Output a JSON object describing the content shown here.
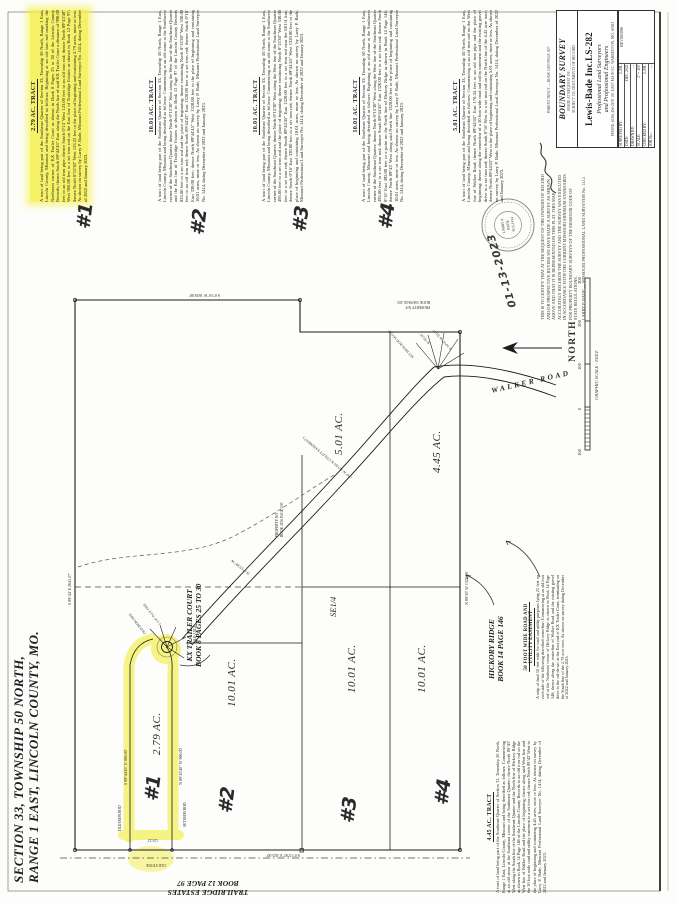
{
  "colors": {
    "highlight": "#f3ee3e",
    "ink": "#1d1d1d",
    "seal_gray": "#777777",
    "paper": "#fdfdfb"
  },
  "sheet_title": {
    "line1": "SECTION 33, TOWNSHIP 50 NORTH,",
    "line2": "RANGE 1 EAST, LINCOLN COUNTY, MO."
  },
  "labels": {
    "kx1": "KX TRAILER COURT",
    "kx2": "BOOK 8 PAGES 25 TO 30",
    "trailridge1": "TRAILRIDGE ESTATES",
    "trailridge2": "BOOK 12 PAGE 97",
    "hickory1": "HICKORY RIDGE",
    "hickory2": "BOOK 14 PAGE 146",
    "quarter": "SE1/4",
    "north": "NORTH",
    "walker_road": "WALKER ROAD",
    "scale_caption": "GRAPHIC SCALE - FEET",
    "road_easement": "( 50' W. ROAD & UTILITY EASEMENT )"
  },
  "scale_ticks": [
    "100",
    "0",
    "100",
    "200",
    "300"
  ],
  "acreage": {
    "t1": "2.79 AC.",
    "t2": "10.01 AC.",
    "t3": "10.01 AC.",
    "t4": "10.01 AC.",
    "t5": "5.01 AC.",
    "t6": "4.45 AC."
  },
  "handwritten": {
    "n1": "#1",
    "n2": "#2",
    "n3": "#3",
    "n4": "#4",
    "date": "01-13-2023"
  },
  "micro": {
    "m1": "S 89°44'45\" E  990.00'",
    "m2": "N 89°43'40\" W  966.00'",
    "m3": "S 89°44' E  2641.27'",
    "m4": "N 89°43' W  1320.00'",
    "m5": "S 0°15'30\" E  825.00'",
    "m6": "S 0°16' W  1650.00'",
    "m7": "OLD IRON ROD",
    "m8": "SET IRON ROD",
    "m9": "OLD STONE",
    "m10": "OLD IRON PIPE",
    "m11": "1-1/4\" O.I.P. FND.",
    "m12": "PROPERTY N/F",
    "m13": "BOOK 1156 PAGE 100",
    "m14": "PROPERTY N/F",
    "m15": "BOOK 558 PAGE 203",
    "m16": "SET IRON ROD W/CAP",
    "m17": "R=50.00'",
    "m18": "N 14°07' W  50.00'",
    "m19": "OLD AXLE",
    "m20": "123.22'",
    "m21": "N 0°15'30\" W"
  },
  "tracts": [
    {
      "heading": "2.79 AC. TRACT",
      "number": "#1",
      "highlighted": true,
      "body": "A tract of land being part of the Southeast Quarter of Section 33, Township 50 North, Range 1 East, Lincoln County, Missouri and being described as follows: Beginning at an old iron rod marking the Northwest corner of KX Trailer Court as shown in Book 8 Pages 25 to 30 of the Lincoln County Records; thence South 89°44'45\" East along the North line of said KX Trailer Court a distance of 990.00 feet to an old iron pipe; thence South 0°15' West 123.00 feet to an old iron rod; thence North 89°43'40\" West 966.00 feet to a set iron rod on the East line of Trailridge Estates as shown in Book 12 Page 97; thence North 0°15'30\" West 123.22 feet to the place of beginning and containing 2.79 acres, more or less. As shown on survey by Larry P. Bade, Missouri Professional Land Surveyor No. 1414, dating December of 2022 and January 2023."
    },
    {
      "heading": "10.01 AC. TRACT",
      "number": "#2",
      "highlighted": false,
      "body": "A tract of land being part of the Southeast Quarter of Section 33, Township 50 North, Range 1 East, Lincoln County, Missouri and being described as follows: Commencing at an old stone at the Southwest corner of the Southeast Quarter; thence North 0°15'30\" West along the West line of the Southeast Quarter and the East line of Trailridge Estates as shown in Book 12 Page 97 of the Lincoln County Records 825.00 feet to a set iron rod and the place of beginning; thence continuing North 0°15'30\" West 330.00 feet to an old iron rod; thence South 89°44'45\" East 1320.00 feet to a set iron rod; thence South 0°16' East 330.00 feet; thence North 89°44'45\" West 1320.00 feet to the place of beginning and containing 10.01 acres, more or less. As shown on survey by Larry P. Bade, Missouri Professional Land Surveyor No. 1414, dating December of 2022 and January 2023."
    },
    {
      "heading": "10.01 AC. TRACT",
      "number": "#3",
      "highlighted": false,
      "body": "A tract of land being part of the Southeast Quarter of Section 33, Township 50 North, Range 1 East, Lincoln County, Missouri and being described as follows: Commencing at an old stone at the Southwest corner of the Southeast Quarter; thence North 0°15'30\" West along the West line of the Southeast Quarter 495.00 feet to a set iron rod and the place of beginning; thence continuing North 0°15'30\" West 330.00 feet to a set iron rod; thence South 89°44'45\" East 1320.00 feet to a set iron rod near the SE1/4 line; thence South 0°16' East 330.00 feet to a set iron rod; thence North 89°44'45\" West 1320.00 feet to the place of beginning and containing 10.01 acres, more or less. As shown on survey by Larry P. Bade, Missouri Professional Land Surveyor No. 1414, dating December of 2022 and January 2023."
    },
    {
      "heading": "10.01 AC. TRACT",
      "number": "#4",
      "highlighted": false,
      "body": "A tract of land being part of the Southeast Quarter of Section 33, Township 50 North, Range 1 East, Lincoln County, Missouri and being described as follows: Beginning at an old stone at the Southwest corner of the Southeast Quarter; thence North 0°15'30\" West along the West line of the Southeast Quarter 495.00 feet to a set iron rod; thence South 89°44'45\" East 1320.00 feet to a set iron rod; thence South 0°16' East 495.00 feet to a point on the North line of Hickory Ridge as shown in Book 14 Page 146; thence North 89°43' West along said North line 1320.00 feet to the place of beginning and containing 10.01 acres, more or less. As shown on survey by Larry P. Bade, Missouri Professional Land Surveyor No. 1414, dating December of 2022 and January 2023."
    },
    {
      "heading": "5.01 AC. TRACT",
      "number": "",
      "highlighted": false,
      "body": "A tract of land being part of the Southeast Quarter of Section 33, Township 50 North, Range 1 East, Lincoln County, Missouri and being described as follows: Commencing at an old iron rod on the West line of Walker Road; thence North 89°44'45\" East 178.34 feet to an old iron pipe and the place of beginning; thence along the centerline of a 50 foot wide road and utility easement and the existing gravel drive to a set iron rod; thence South 0°16' West to a set iron rod on the North line of the 4.45 acre tract; thence North 89°44'45\" West to the place of beginning and containing 5.01 acres, more or less. As shown on survey by Larry P. Bade, Missouri Professional Land Surveyor No. 1414, dating December of 2022 and January 2023."
    }
  ],
  "bottom_tract": {
    "heading": "4.45 AC. TRACT",
    "body": "A tract of land being part of the Southeast Quarter of Section 33, Township 50 North, Range 1 East, Lincoln County, Missouri and being described as follows: Commencing at an old stone at the Southeast corner of the Southeast Quarter; thence North 89°43' West along the South line of the Southeast Quarter and the North line of Hickory Ridge as shown in Book 14 Page 146 of the Lincoln County Records to an old iron rod on the West line of Walker Road and the place of beginning; thence along said West line and the 50 foot wide road and utility easement to a set iron rod; thence North 89°43' West to the place of beginning and containing 4.45 acres, more or less. As shown on survey by Larry P. Bade, Missouri Professional Land Surveyor No. 1414, dating December of 2022 and January 2023."
  },
  "easement_note": {
    "heading1": "50 FOOT WIDE ROAD AND",
    "heading2": "UTILITY EASEMENT",
    "body": "A strip of land 50 feet wide for road and utility purposes lying 25 feet on each side of the following described centerline: Commencing at an old iron rod at the Northeast corner of Hickory Ridge as shown in Book 14 Page 146; thence along the centerline of Walker Road and the existing gravel drive to the cul-de-sac at the East end of KX Trailer Court, terminating on the South line of the 2.79 acre tract. As shown on survey dating December of 2022 and January 2023."
  },
  "certification": {
    "lines": [
      "THIS IS TO CERTIFY THAT AT THE REQUEST OF THE OWNERS OF RECORD",
      "AND/OR PROSPECTIVE BUYERS WE HAVE MADE A SURVEY AS SHOWN",
      "ABOVE AND THAT IT IS REPRESENTED ON THIS PLAT. THIS MAP",
      "ACCURATELY RECORDS THE SURVEY AND THE SURVEY WAS EXECUTED",
      "IN ACCORDANCE WITH THE CURRENT MISSOURI MINIMUM STANDARDS",
      "FOR PROPERTY BOUNDARY SURVEYS OF THE MISSOURI CODE OF",
      "STATE REGULATIONS."
    ],
    "signer": "LARRY P. BADE — MISSOURI PROFESSIONAL LAND SURVEYOR No. 1414",
    "seal_line1": "LARRY P.",
    "seal_line2": "BADE",
    "seal_line3": "PLS-1414"
  },
  "title_block": {
    "survey_type": "BOUNDARY SURVEY",
    "made_at": "MADE AT REQUEST OF: ____________",
    "subject": "SUBJECT TO: DOCUMENTS OF RECORD",
    "company": "Lewis-Bade Inc.",
    "company_suffix": "LS-282",
    "line_a": "Professional Land Surveyors",
    "line_b": "and Professional Engineers",
    "phone": "PHONE: (636) 456-2478   101 EAST MAIN ST., WARRENTON, MO. 63383",
    "parent_note": "PARENT TRACT — BOOK 1483 PAGE 307",
    "fields": {
      "surveyed_label": "SURVEYED BY:",
      "surveyed_value": "L.P.B.",
      "date_label": "DATE:",
      "date_value": "DEC. 2022",
      "drawn_label": "DRAWN BY:",
      "drawn_value": "—",
      "scale_label": "SCALE:",
      "scale_value": "1\" = 100'",
      "checked_label": "CHECKED BY:",
      "checked_value": "L.P.B.",
      "job_label": "JOB No.:",
      "job_value": "—",
      "revisions_label": "REVISIONS"
    }
  }
}
